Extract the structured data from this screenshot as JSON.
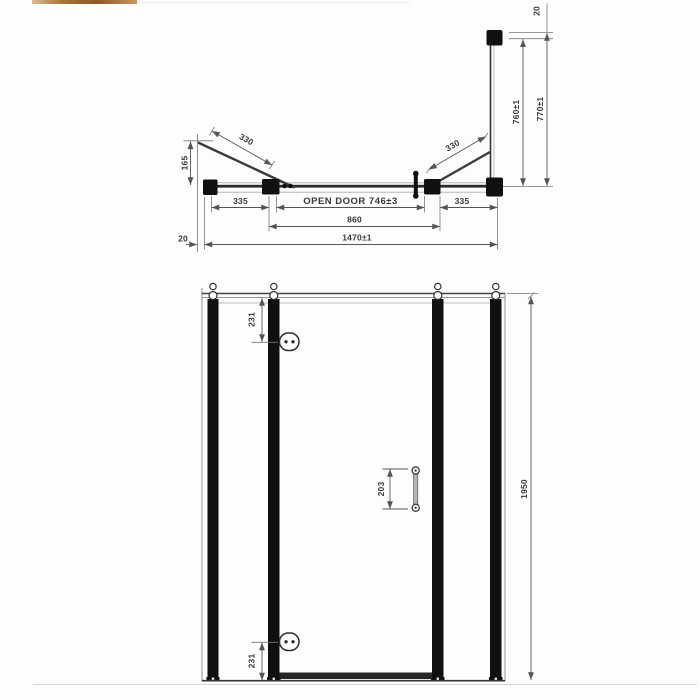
{
  "colors": {
    "line": "#4a4a4a",
    "frame": "#111111",
    "dimension": "#555555",
    "photo_strip": [
      "#d8bb8e",
      "#8a5a28"
    ]
  },
  "plan": {
    "dims": {
      "bracket_height": "165",
      "brace_left": "330",
      "brace_right": "330",
      "panel_left": "335",
      "open_door": "OPEN DOOR  746±3",
      "panel_right": "335",
      "frame_width": "860",
      "overall_width": "1470±1",
      "wall_profile_left": "20",
      "return_glass": "760±1",
      "return_overall": "770±1",
      "wall_profile_top": "20"
    }
  },
  "elevation": {
    "dims": {
      "hinge_top": "231",
      "handle_centres": "203",
      "hinge_bottom": "231",
      "overall_height": "1950"
    }
  }
}
